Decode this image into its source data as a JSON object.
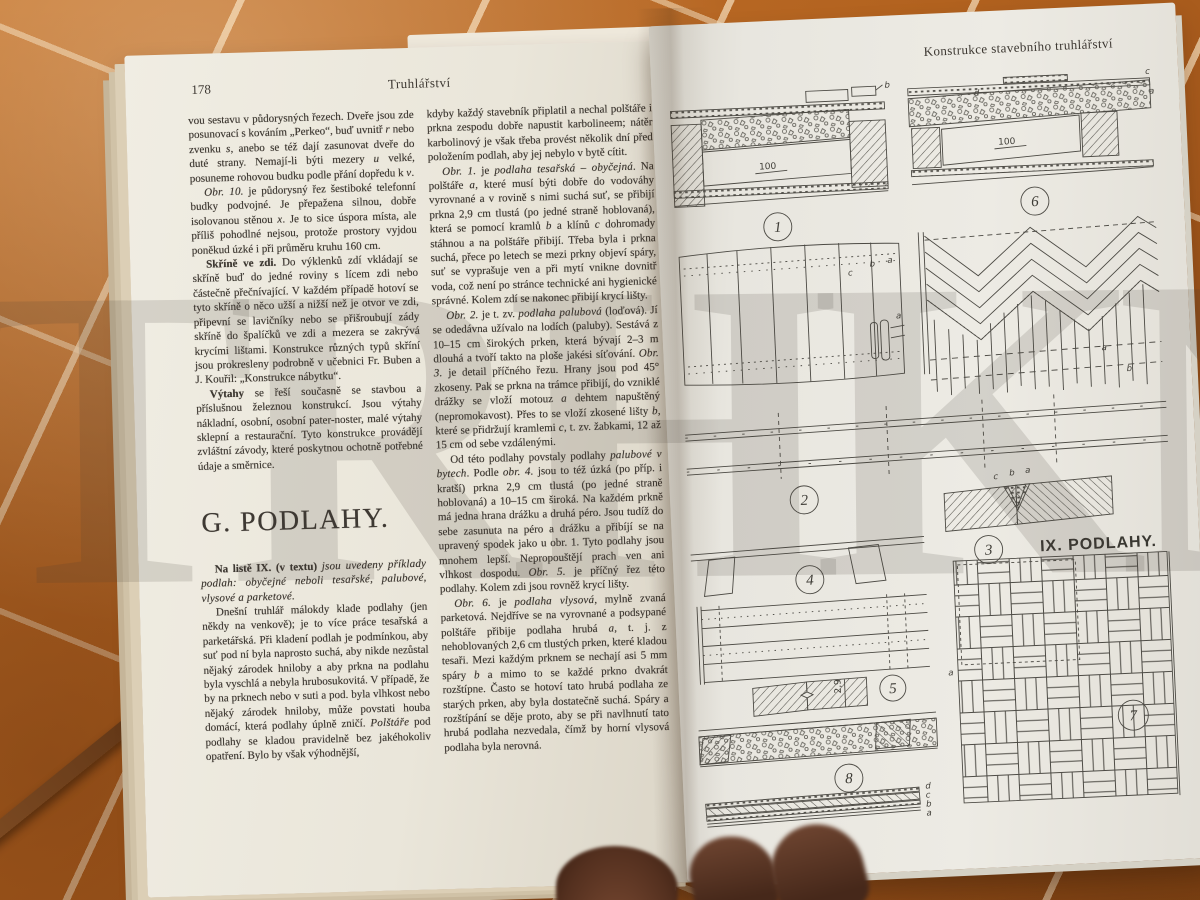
{
  "watermark": "TRHKNIH",
  "left_page": {
    "page_number": "178",
    "running_header": "Truhlářství",
    "column1": [
      {
        "type": "p",
        "noindent": true,
        "text": "vou sestavu v půdorysných řezech. Dveře jsou zde posunovací s kováním „Perkeo“, buď uvnitř *r* nebo zvenku *s*, anebo se též dají zasunovat dveře do duté strany. Nemají-li býti mezery *u* velké, posuneme rohovou budku podle přání dopředu k *v*."
      },
      {
        "type": "p",
        "text": "*Obr. 10.* je půdorysný řez šestiboké telefonní budky podvojné. Je přepažena silnou, dobře isolovanou stěnou *x*. Je to sice úspora místa, ale příliš pohodlné nejsou, protože prostory vyjdou poněkud úzké i při průměru kruhu 160 cm."
      },
      {
        "type": "p",
        "text": "**Skříně ve zdi.** Do výklenků zdí vkládají se skříně buď do jedné roviny s lícem zdi nebo částečně přečnívající. V každém případě hotoví se tyto skříně o něco užší a nižší než je otvor ve zdi, připevní se lavičníky nebo se přišroubují zády skříně do špalíčků ve zdi a mezera se zakrývá krycími lištami. Konstrukce různých typů skříní jsou prokresleny podrobně v učebnici Fr. Buben a J. Kouřil: „Konstrukce nábytku“."
      },
      {
        "type": "p",
        "text": "**Výtahy** se řeší současně se stavbou a příslušnou železnou konstrukcí. Jsou výtahy nákladní, osobní, osobní pater-noster, malé výtahy sklepní a restaurační. Tyto konstrukce provádějí zvláštní závody, které poskytnou ochotně potřebné údaje a směrnice."
      },
      {
        "type": "h",
        "text": "G. PODLAHY."
      },
      {
        "type": "p",
        "text": "**Na listě IX. (v textu)** *jsou uvedeny příklady podlah: obyčejné neboli tesařské, palubové, vlysové a parketové.*"
      },
      {
        "type": "p",
        "text": "Dnešní truhlář málokdy klade podlahy (jen někdy na venkově); je to více práce tesařská a parketářská. Při kladení podlah je podmínkou, aby suť pod ní byla naprosto suchá, aby nikde nezůstal nějaký zárodek hniloby a aby prkna na podlahu byla vyschlá a nebyla hrubosukovitá. V případě, že by na prknech nebo v suti a pod. byla vlhkost nebo nějaký zárodek hniloby, může povstati houba domácí, která podlahy úplně zničí. *Polštáře* pod podlahy se kladou pravidelně bez jakéhokoliv opatření. Bylo by však výhodnější,"
      }
    ],
    "column2": [
      {
        "type": "p",
        "noindent": true,
        "text": "kdyby každý stavebník připlatil a nechal polštáře i prkna zespodu dobře napustit karbolineem; nátěr karbolinový je však třeba provést několik dní před položením podlah, aby jej nebylo v bytě cítit."
      },
      {
        "type": "p",
        "text": "*Obr. 1.* je *podlaha tesařská – obyčejná*. Na polštáře *a*, které musí býti dobře do vodováhy vyrovnané a v rovině s nimi suchá suť, se přibijí prkna 2,9 cm tlustá (po jedné straně hoblovaná), která se pomocí kramlů *b* a klínů *c* dohromady stáhnou a na polštáře přibijí. Třeba byla i prkna suchá, přece po letech se mezi prkny objeví spáry, suť se vyprašuje ven a při mytí vnikne dovnitř voda, což není po stránce technické ani hygienické správné. Kolem zdí se nakonec přibijí krycí lišty."
      },
      {
        "type": "p",
        "text": "*Obr. 2.* je t. zv. *podlaha palubová* (loďová). Jí se odedávna užívalo na lodích (paluby). Sestává z 10–15 cm širokých prken, která bývají 2–3 m dlouhá a tvoří takto na ploše jakési síťování. *Obr. 3.* je detail příčného řezu. Hrany jsou pod 45° zkoseny. Pak se prkna na trámce přibijí, do vzniklé drážky se vloží motouz *a* dehtem napuštěný (nepromokavost). Přes to se vloží zkosené lišty *b*, které se přidržují kramlemi *c*, t. zv. žabkami, 12 až 15 cm od sebe vzdálenými."
      },
      {
        "type": "p",
        "text": "Od této podlahy povstaly podlahy *palubové v bytech*. Podle *obr. 4.* jsou to též úzká (po příp. i kratší) prkna 2,9 cm tlustá (po jedné straně hoblovaná) a 10–15 cm široká. Na každém prkně má jedna hrana drážku a druhá péro. Jsou tudíž do sebe zasunuta na péro a drážku a přibíjí se na upravený spodek jako u obr. 1. Tyto podlahy jsou mnohem lepší. Nepropouštějí prach ven ani vlhkost dospodu. *Obr. 5.* je příčný řez této podlahy. Kolem zdi jsou rovněž krycí lišty."
      },
      {
        "type": "p",
        "text": "*Obr. 6.* je *podlaha vlysová*, mylně zvaná parketová. Nejdříve se na vyrovnané a podsypané polštáře přibije podlaha hrubá *a*, t. j. z nehoblovaných 2,6 cm tlustých prken, které kladou tesaři. Mezi každým prknem se nechají asi 5 mm spáry *b* a mimo to se každé prkno dvakrát rozštípne. Často se hotoví tato hrubá podlaha ze starých prken, aby byla dostatečně suchá. Spáry a rozštípání se děje proto, aby se při navlhnutí tato hrubá podlaha nezvedala, čímž by horní vlysová podlaha byla nerovná."
      }
    ]
  },
  "right_page": {
    "running_header": "Konstrukce stavebního truhlářství",
    "plate_label": "IX. PODLAHY.",
    "figures": {
      "f1": "1",
      "f2": "2",
      "f3": "3",
      "f4": "4",
      "f5": "5",
      "f6": "6",
      "f7": "7",
      "f8": "8"
    },
    "dims": {
      "fig1_width": "100",
      "fig6_width": "100",
      "fig5_thickness": "2,9"
    },
    "part_labels": {
      "a": "a",
      "b": "b",
      "c": "c",
      "d": "d"
    }
  }
}
